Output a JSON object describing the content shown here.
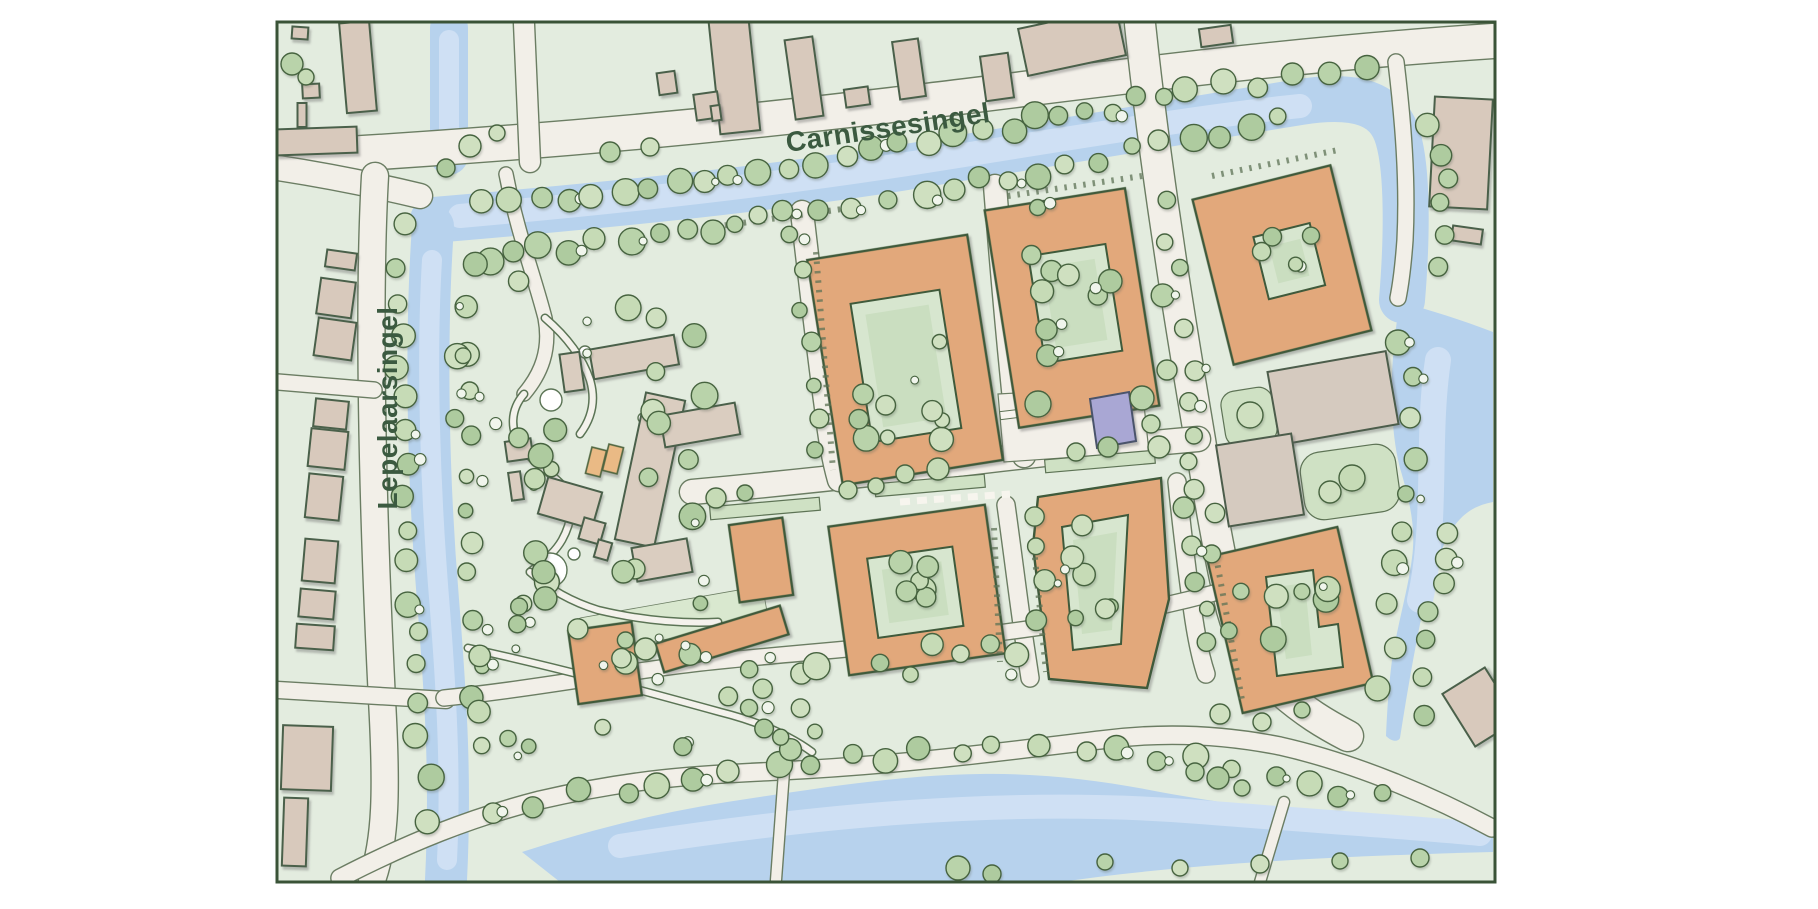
{
  "map": {
    "street_labels": [
      {
        "id": "carnissesingel",
        "text": "Carnissesingel"
      },
      {
        "id": "lepelaarsingel",
        "text": "Lepelaarsingel"
      }
    ],
    "colors": {
      "background": "#e3ecdf",
      "road": "#f2efe8",
      "water": "#b7d2ed",
      "water_highlight": "#cfe0f4",
      "building_new_orange": "#e2a87b",
      "building_existing_tan": "#d8c9bc",
      "building_special_purple": "#a9a7d4",
      "courtyard_green": "#d7e6cf",
      "tree_green": "#b9d3aa",
      "outline_green": "#3f5a3b",
      "label_text": "#3b5a40",
      "frame": "#3a5337"
    }
  }
}
